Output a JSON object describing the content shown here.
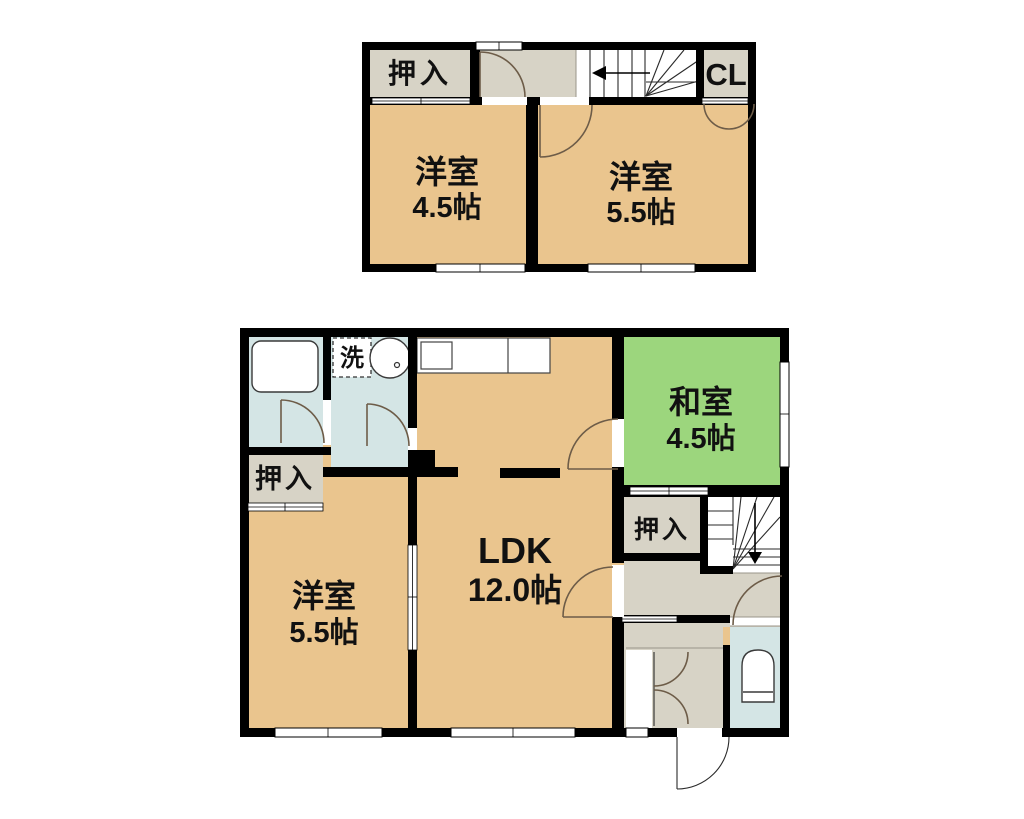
{
  "type": "floor-plan",
  "title": "2-story apartment floor plan (2LDK+2)",
  "colors": {
    "room_tan": "#EAC58E",
    "tatami_green": "#9CD67D",
    "wet_area_blue": "#D4E5E5",
    "closet_gray": "#D7D3C6",
    "wall_black": "#000000",
    "door_arc_brown": "#6D5C48",
    "background": "#FFFFFF"
  },
  "labels": {
    "closet_2f": "押入",
    "cl": "CL",
    "western_2f_left_name": "洋室",
    "western_2f_left_size": "4.5帖",
    "western_2f_right_name": "洋室",
    "western_2f_right_size": "5.5帖",
    "laundry": "洗",
    "closet_1f_left": "押入",
    "western_1f_name": "洋室",
    "western_1f_size": "5.5帖",
    "ldk_name": "LDK",
    "ldk_size": "12.0帖",
    "japanese_name": "和室",
    "japanese_size": "4.5帖",
    "closet_1f_right": "押入"
  },
  "floors": [
    {
      "name": "2F",
      "rooms": [
        {
          "id": "closet-2f",
          "label": "押入",
          "type": "closet"
        },
        {
          "id": "hall-2f",
          "label": "",
          "type": "hall"
        },
        {
          "id": "stairs-2f",
          "label": "",
          "type": "stairs",
          "direction": "arrow-left"
        },
        {
          "id": "closet-cl",
          "label": "CL",
          "type": "closet"
        },
        {
          "id": "western-room-2f-left",
          "label": "洋室",
          "size": "4.5帖",
          "type": "western-room"
        },
        {
          "id": "western-room-2f-right",
          "label": "洋室",
          "size": "5.5帖",
          "type": "western-room"
        }
      ]
    },
    {
      "name": "1F",
      "rooms": [
        {
          "id": "bathroom",
          "label": "",
          "type": "bathroom",
          "fixtures": [
            "bathtub"
          ]
        },
        {
          "id": "washroom",
          "label": "洗",
          "type": "washroom",
          "fixtures": [
            "washer-space",
            "sink"
          ]
        },
        {
          "id": "closet-1f-left",
          "label": "押入",
          "type": "closet"
        },
        {
          "id": "western-room-1f",
          "label": "洋室",
          "size": "5.5帖",
          "type": "western-room"
        },
        {
          "id": "ldk",
          "label": "LDK",
          "size": "12.0帖",
          "type": "living-dining-kitchen",
          "fixtures": [
            "kitchen-counter"
          ]
        },
        {
          "id": "japanese-room",
          "label": "和室",
          "size": "4.5帖",
          "type": "japanese-room"
        },
        {
          "id": "closet-1f-right",
          "label": "押入",
          "type": "closet"
        },
        {
          "id": "stairs-1f",
          "label": "",
          "type": "stairs",
          "direction": "arrow-down"
        },
        {
          "id": "hall-entrance",
          "label": "",
          "type": "entrance-hall",
          "fixtures": [
            "shoe-closet-double-doors",
            "entrance-door"
          ]
        },
        {
          "id": "toilet",
          "label": "",
          "type": "toilet",
          "fixtures": [
            "toilet-bowl"
          ]
        }
      ]
    }
  ]
}
